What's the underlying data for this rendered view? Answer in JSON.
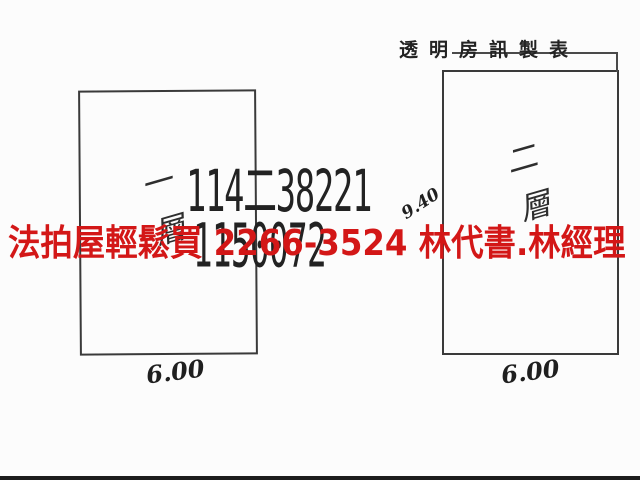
{
  "colors": {
    "paper": "#fcfcfc",
    "ink": "#2e2e2e",
    "watermark_red": "#d31717",
    "bottom_bar": "#1c1c1c"
  },
  "header": {
    "title": "透明房訊製表"
  },
  "stamp": {
    "line1": "114二38221",
    "line2": "1150072"
  },
  "watermark": {
    "text": "法拍屋輕鬆買  2266-3524  林代書.林經理"
  },
  "plans": [
    {
      "id": "left",
      "floor_label": "一層",
      "width_label": "6.00"
    },
    {
      "id": "right",
      "floor_label": "二層",
      "width_label": "6.00",
      "depth_label": "9.40"
    }
  ]
}
